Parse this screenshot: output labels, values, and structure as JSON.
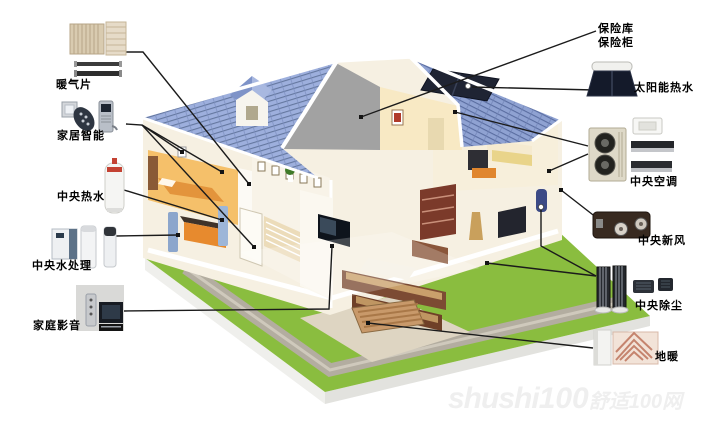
{
  "page": {
    "width": 717,
    "height": 426,
    "background": "#ffffff",
    "description": "cutaway 3d house diagram of whole-home comfort systems"
  },
  "systems": {
    "left": [
      {
        "id": "radiator",
        "label": "暖气片",
        "icon": "radiator-icon"
      },
      {
        "id": "smart_home",
        "label": "家居智能",
        "icon": "smart-lock-icon"
      },
      {
        "id": "central_hot_water",
        "label": "中央热水",
        "icon": "water-heater-tank-icon"
      },
      {
        "id": "central_water_treatment",
        "label": "中央水处理",
        "icon": "water-filter-icon"
      },
      {
        "id": "home_av",
        "label": "家庭影音",
        "icon": "home-theater-icon"
      }
    ],
    "right": [
      {
        "id": "safe",
        "label_line1": "保险库",
        "label_line2": "保险柜",
        "icon": "safe-location-dot"
      },
      {
        "id": "solar_hot_water",
        "label": "太阳能热水",
        "icon": "solar-collector-icon"
      },
      {
        "id": "central_ac",
        "label": "中央空调",
        "icon": "ac-outdoor-unit-icon"
      },
      {
        "id": "central_fresh_air",
        "label": "中央新风",
        "icon": "heat-recovery-ventilator-icon"
      },
      {
        "id": "central_vacuum",
        "label": "中央除尘",
        "icon": "vacuum-tower-icon"
      },
      {
        "id": "floor_heating",
        "label": "地暖",
        "icon": "floor-heating-coil-icon"
      }
    ]
  },
  "watermark": {
    "latin": "shushi",
    "number": "100",
    "cn": "舒适100网"
  },
  "colors": {
    "leader_line": "#1b1b1b",
    "roof_tile_left": "#9dafdd",
    "roof_tile_right": "#8fa2d2",
    "roof_trim": "#ffffff",
    "gable_gray": "#a2a2a2",
    "wall_cream": "#f6f0e2",
    "room_warm": "#f5c06a",
    "accent_orange": "#e78a2e",
    "lawn_green": "#8abd3f",
    "path_gray": "#b3ada0",
    "solar_panel": "#1f2433"
  }
}
